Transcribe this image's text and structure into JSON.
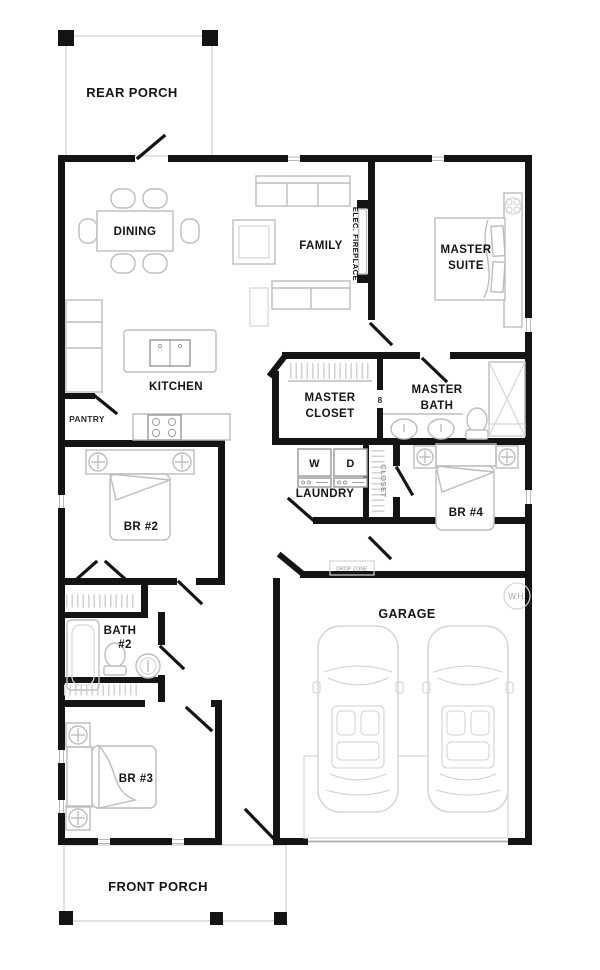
{
  "plan": {
    "type": "residential-floor-plan",
    "colors": {
      "background": "#ffffff",
      "wall": "#141414",
      "furniture_outline": "#bdbdbd",
      "appliance_outline": "#9e9e9e",
      "label_text": "#151515",
      "muted_text": "#9a9a9a"
    }
  },
  "labels": {
    "rear_porch": "REAR PORCH",
    "dining": "DINING",
    "family": "FAMILY",
    "fireplace": "ELEC. FIREPLACE",
    "master_suite_line1": "MASTER",
    "master_suite_line2": "SUITE",
    "kitchen": "KITCHEN",
    "pantry": "PANTRY",
    "master_closet_line1": "MASTER",
    "master_closet_line2": "CLOSET",
    "master_bath_line1": "MASTER",
    "master_bath_line2": "BATH",
    "door_marker": "8",
    "washer": "W",
    "dryer": "D",
    "laundry": "LAUNDRY",
    "hall_closet": "CLOSET",
    "bedroom2": "BR #2",
    "bedroom4": "BR #4",
    "bath2_line1": "BATH",
    "bath2_line2": "#2",
    "drop_zone": "DROP ZONE",
    "garage": "GARAGE",
    "water_heater": "W.H.",
    "bedroom3": "BR #3",
    "front_porch": "FRONT PORCH"
  }
}
